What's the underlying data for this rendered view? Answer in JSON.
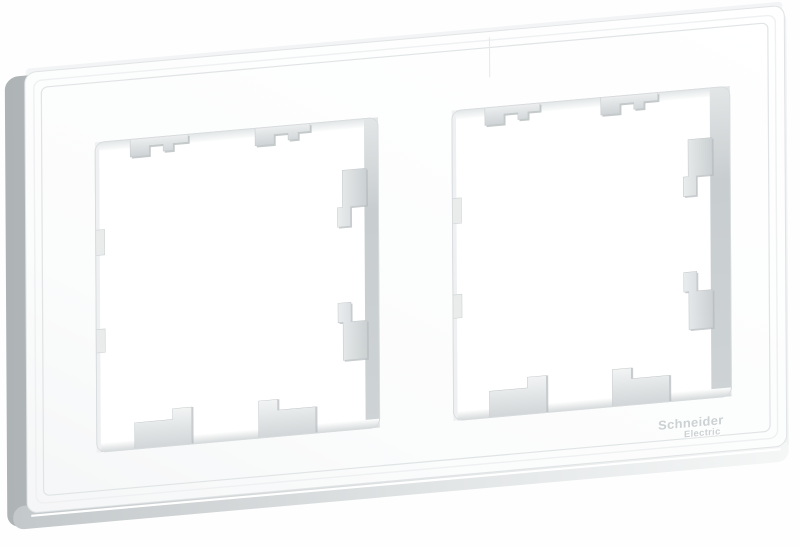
{
  "image": {
    "description": "White two-gang wall frame for light switches and sockets, shown at a slight angle on a white background",
    "brand": {
      "line1": "Schneider",
      "line2": "Electric"
    },
    "colors": {
      "background": "#fefefe",
      "frame_face": "#fbfcfc",
      "frame_side_shadow": "#b2b8ba",
      "inner_wall_gray": "#c9ced0",
      "clip_gray": "#d4d8da",
      "groove_line": "#e0e4e5",
      "logo_gray": "#ccd1d3"
    }
  }
}
